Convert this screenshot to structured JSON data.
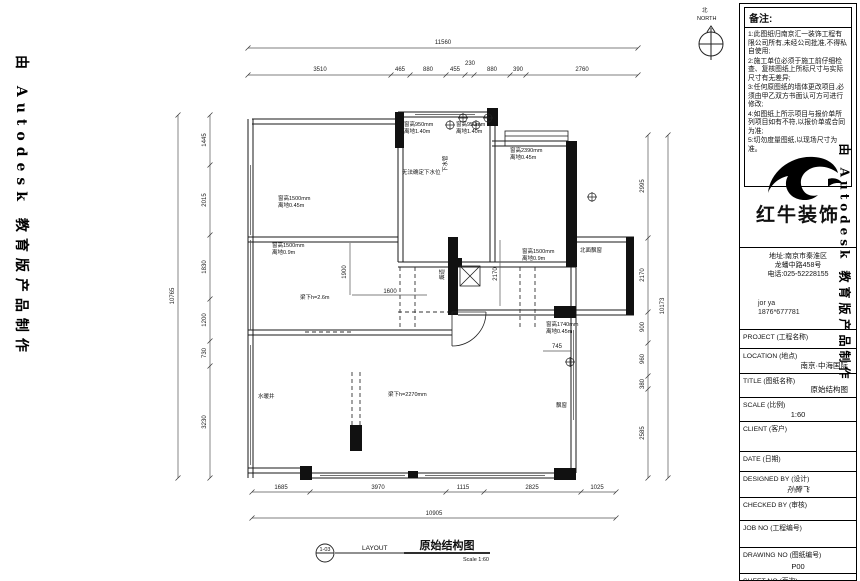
{
  "watermark": {
    "text": "由 Autodesk 教育版产品制作"
  },
  "north": {
    "cn": "北",
    "en": "NORTH"
  },
  "tb": {
    "notes_header": "备注:",
    "notes": [
      "1:此图纸归南京汇一装饰工程有限公司所有,未经公司批准,不得私自使用;",
      "2:施工单位必须于施工前仔细检查、复核图纸上所标尺寸与实际尺寸有无差异;",
      "3:任何原图纸的墙体更改项目,必须由甲乙双方书面认可方可进行修改;",
      "4:如图纸上所示项目与报价单所列项目如有不符,以报价单或合同为准;",
      "5:切勿度量图纸,以现场尺寸为准。"
    ],
    "brand": {
      "name": "红牛装饰",
      "addr1": "地址:南京市秦淮区",
      "addr2": "龙蟠中路458号",
      "phone": "电话:025-52228155",
      "contact": "jor ya",
      "contact_phone": "1876*677781"
    },
    "fields": [
      {
        "label": "PROJECT (工程名称)",
        "value": ""
      },
      {
        "label": "LOCATION (地点)",
        "value": "南京·中海国际"
      },
      {
        "label": "TITLE (图纸名称)",
        "value": "原始结构图"
      },
      {
        "label": "SCALE (比例)",
        "value": "1:60"
      },
      {
        "label": "CLIENT (客户)",
        "value": ""
      },
      {
        "label": "DATE (日期)",
        "value": ""
      },
      {
        "label": "DESIGNED BY (设计)",
        "value": "孙腾飞"
      },
      {
        "label": "CHECKED BY (审核)",
        "value": ""
      },
      {
        "label": "JOB NO (工程编号)",
        "value": ""
      },
      {
        "label": "DRAWING NO (图纸编号)",
        "value": "P00"
      },
      {
        "label": "SHEET NO (页次)",
        "value": ""
      }
    ]
  },
  "footer": {
    "mark": "1-03",
    "layout": "LAYOUT",
    "title": "原始结构图",
    "scale": "Scale 1:60"
  },
  "plan": {
    "dims": {
      "top_total": "11560",
      "top": [
        "3510",
        "465",
        "880",
        "455",
        "230",
        "880",
        "390",
        "2760"
      ],
      "left_total": "10765",
      "left": [
        "1445",
        "2015",
        "1830",
        "1200",
        "730",
        "3230"
      ],
      "right_total": "10173",
      "right": [
        "2995",
        "2170",
        "900",
        "960",
        "380",
        "2585"
      ],
      "bottom_total": "10905",
      "bottom": [
        "1685",
        "3970",
        "1115",
        "2825",
        "1025"
      ],
      "interior": [
        "1900",
        "1600",
        "2170",
        "745"
      ]
    },
    "ann": [
      "窗高1500mm",
      "离地0.45m",
      "窗高950mm",
      "离地1.40m",
      "窗高950mm",
      "离地1.40m",
      "无法确定下水位",
      "下水管",
      "窗高2390mm",
      "离地0.45m",
      "窗高1500mm",
      "离地0.9m",
      "梁下h=2.6m",
      "烟道",
      "北面飘窗",
      "窗高1500mm",
      "离地0.9m",
      "窗高1740mm",
      "离地0.45m",
      "水暖井",
      "梁下h=2270mm",
      "飘窗"
    ]
  }
}
